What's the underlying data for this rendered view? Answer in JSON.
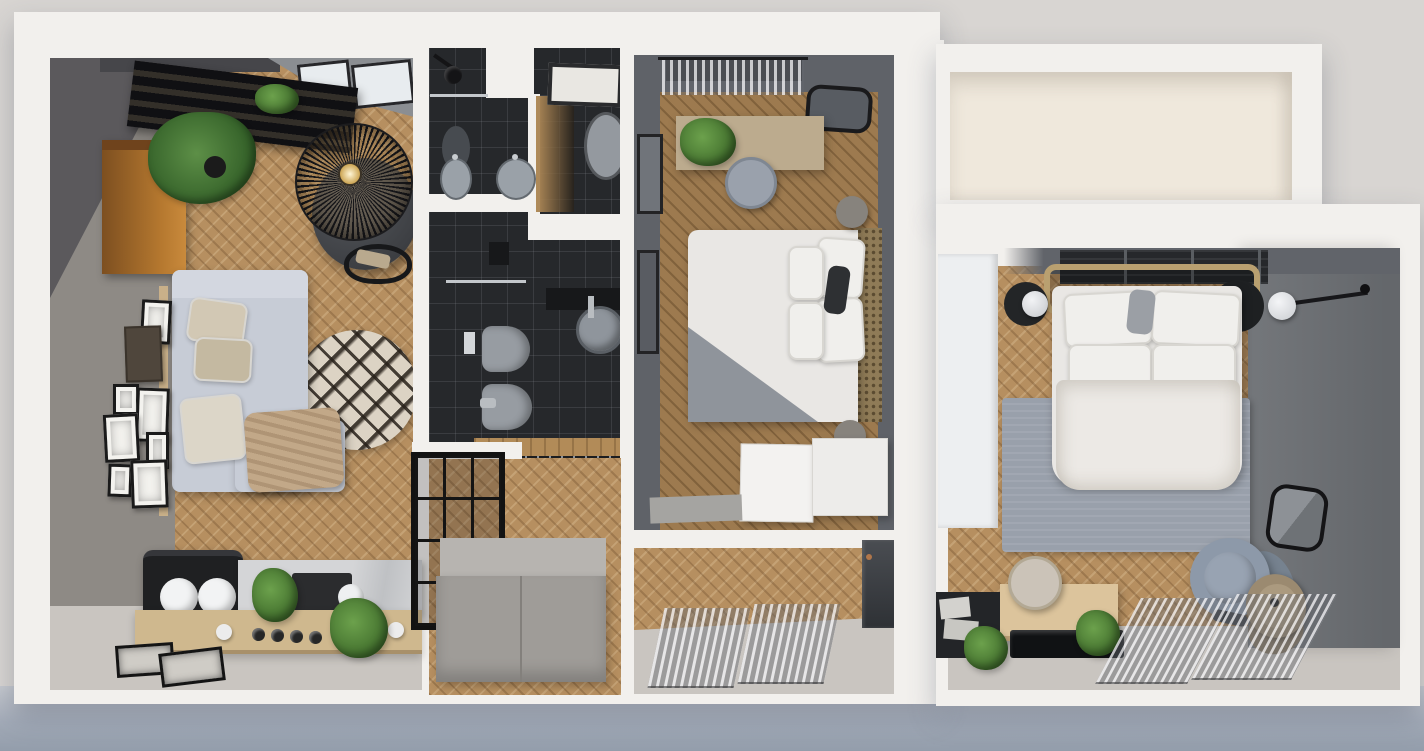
{
  "scene": {
    "title": "Top-down 3D render of an apartment floor plan (dollhouse view)",
    "type": "architectural-render",
    "no_visible_text": true
  },
  "palette": {
    "bg_top": "#d8d5d2",
    "bg_bottom": "#939dab",
    "wall_white": "#f2f0ed",
    "wall_gray": "#8e8a85",
    "wall_dark_mid": "#5f6268",
    "wall_dark_right": "#74777b",
    "floor_wood": "#b68f60",
    "floor_wood_dark": "#9d7a4f",
    "floor_concrete": "#c9c5c0",
    "tile_dark": "#26282b",
    "sofa_gray": "#c7ccd6",
    "bed_white": "#e9e7e4",
    "rug_cream": "#dcd3c4",
    "rug_gray": "#99a0ab",
    "cabinet_wood": "#a96f33",
    "counter_wood": "#cfb88e",
    "marble": "#d4d5d7",
    "plant_green": "#4e7a37",
    "black_fixture": "#1c1d1f",
    "rattan_tan": "#b9a070"
  },
  "rooms": [
    {
      "id": "living-room",
      "label": "Living room",
      "furniture": [
        "skylight windows",
        "black ladder shelf with books",
        "wood cabinet",
        "potted plants",
        "wire pendant lamp",
        "round dining table",
        "black chair",
        "corner sofa with pillows",
        "throw blanket",
        "round berber rug",
        "gallery wall frames",
        "wall rail"
      ]
    },
    {
      "id": "kitchen",
      "label": "Kitchen",
      "furniture": [
        "black bench with two white cushions",
        "wood counter front with knobs",
        "marble countertop",
        "dark cooktop",
        "round sink",
        "herb plants",
        "framed pictures on floor"
      ]
    },
    {
      "id": "shower-wc",
      "label": "Shower room and WC",
      "furniture": [
        "shower head",
        "glass shelf",
        "oval mirror",
        "double vanity basins",
        "skylight",
        "toilet"
      ]
    },
    {
      "id": "main-bathroom",
      "label": "Main bathroom",
      "furniture": [
        "wall cabinet",
        "shower screen",
        "wall-hung toilet",
        "flush plate",
        "bidet",
        "round basin on dark counter",
        "wood threshold",
        "drain grate"
      ]
    },
    {
      "id": "hallway",
      "label": "Hallway",
      "furniture": [
        "black glass partition",
        "gray wardrobe"
      ]
    },
    {
      "id": "bedroom-middle",
      "label": "Bedroom 1",
      "furniture": [
        "window with sheer curtain",
        "mirror",
        "wall frames",
        "desk with plant",
        "round stool",
        "double bed with gray fold",
        "pillows",
        "rattan headboard",
        "two poufs",
        "white dressers",
        "gray doormat"
      ]
    },
    {
      "id": "entry-hall",
      "label": "Entry hall",
      "furniture": [
        "sheer curtain panels",
        "dark entry door"
      ]
    },
    {
      "id": "empty-room",
      "label": "Empty room",
      "furniture": []
    },
    {
      "id": "bedroom-right",
      "label": "Bedroom 2",
      "furniture": [
        "white wardrobe",
        "slatted shelf",
        "rattan bed frame",
        "bed with pillows and duvet",
        "black bedside discs",
        "globe wall sconces",
        "gray rug",
        "framed mirror",
        "desk",
        "round stool",
        "dark side table with papers",
        "glossy tray",
        "plants",
        "swivel chair",
        "tan leather chair",
        "sheer curtains"
      ]
    }
  ]
}
